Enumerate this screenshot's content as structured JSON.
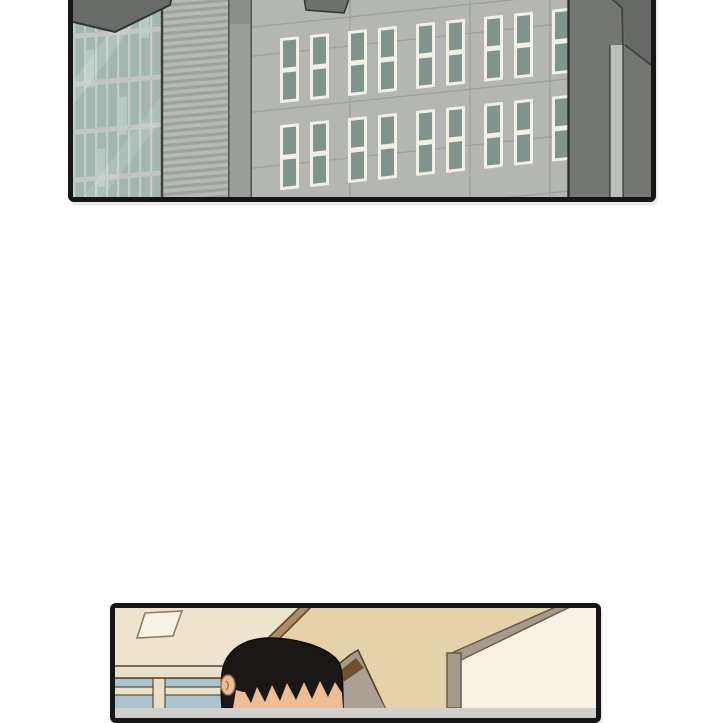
{
  "page": {
    "background": "#ffffff"
  },
  "panels": [
    {
      "id": "city",
      "description": "exterior daytime view of office buildings: glass curtain-wall tower, striped facade, light-grey facade with paired teal windows, dark side wall",
      "text": ""
    },
    {
      "id": "room",
      "description": "office interior: cream ceiling with light fixture, tan walls, window band, door with sign plaque, wall corner, back of a black-haired character's head",
      "text": ""
    }
  ],
  "palette": {
    "page_bg": "#ffffff",
    "panel_border": "#161616",
    "city_facade": "#b4b6b1",
    "city_seam": "#9da09a",
    "city_win_frame": "#f2efe5",
    "city_win_pane": "#7f948d",
    "city_overhang": "#6f716e",
    "glass_pane": "#a2b7b0",
    "glass_pane_light": "#c0cfc9",
    "glass_mullion": "#c9ccc6",
    "glass_band": "#c3c6c1",
    "glass_edge": "#3c3e3b",
    "wedge_fill": "#696b68",
    "wedge_edge": "#333532",
    "wedge_accent": "#e09a3d",
    "stripe_light": "#b7b9b6",
    "stripe_dark": "#9ea19d",
    "pillar_fill": "#9c9e9b",
    "pillar_cap": "#8d8f8a",
    "pillar_edge": "#555753",
    "dark_side": "#747672",
    "dark_side_top": "#666865",
    "dark_pillar": "#bdbfba",
    "dark_edge": "#2e302d",
    "room_ceiling": "#eee4ce",
    "room_wall": "#e5d2ab",
    "room_wall_right": "#f8f2e5",
    "beam_fill": "#b18b5f",
    "beam_edge": "#5d462e",
    "light_fill": "#f7f2e4",
    "light_edge": "#8c7c5e",
    "win_bar": "#e9e0c8",
    "win_pane": "#abc4cf",
    "win_edge": "#5c4c35",
    "plaque_fill": "#f7efde",
    "door_casing": "#a49b8d",
    "door_gap": "#6f5130",
    "door_face": "#a9a195",
    "door_edge": "#503c29",
    "trim_fill": "#a39b8d",
    "trim_edge": "#6d5c42",
    "hair": "#1a1714",
    "skin": "#eebd93",
    "skin_edge": "#9c6b40"
  }
}
